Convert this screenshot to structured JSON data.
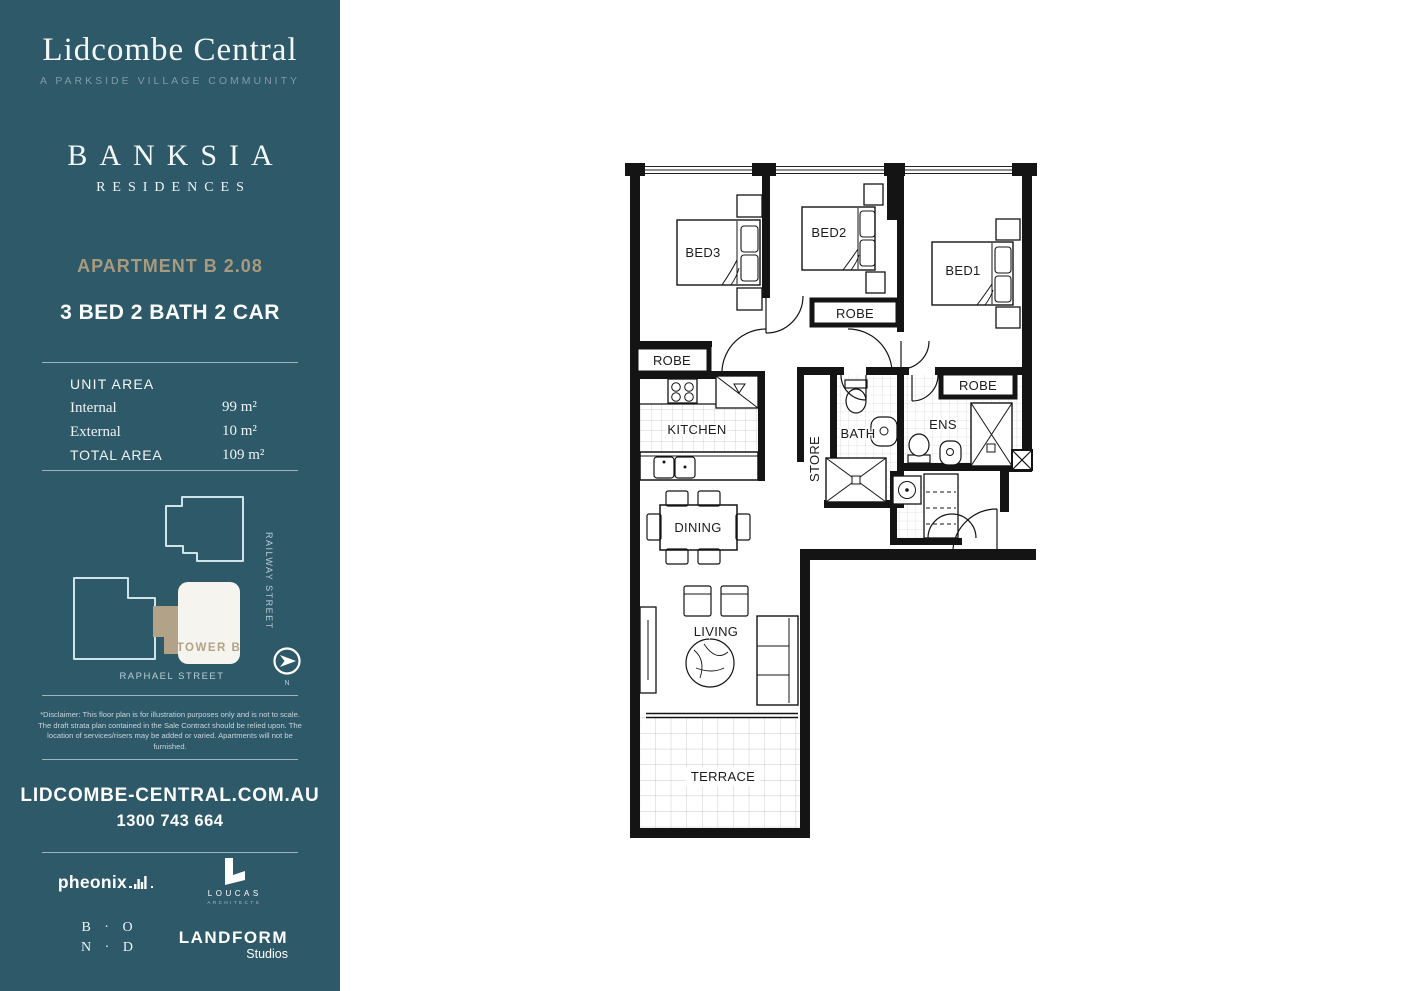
{
  "colors": {
    "sidebar_bg": "#2e5968",
    "accent_gold": "#a89a7f",
    "map_outline": "#cfe3ea",
    "tower_fill": "#f6f4ef",
    "connector_tan": "#b2a287",
    "plan_line": "#141414"
  },
  "sidebar": {
    "brand_title": "Lidcombe Central",
    "brand_subtitle": "A PARKSIDE VILLAGE COMMUNITY",
    "residence_name": "BANKSIA",
    "residence_sub": "RESIDENCES",
    "apartment_label": "APARTMENT B 2.08",
    "apartment_config": "3 BED 2 BATH 2 CAR",
    "unit_area_heading": "UNIT AREA",
    "area_rows": [
      {
        "label": "Internal",
        "value": "99 m²"
      },
      {
        "label": "External",
        "value": "10 m²"
      },
      {
        "label": "TOTAL AREA",
        "value": "109 m²"
      }
    ],
    "map": {
      "tower": "TOWER B",
      "street_side": "RAILWAY STREET",
      "street_bottom": "RAPHAEL STREET",
      "compass": "N"
    },
    "disclaimer_lines": [
      "*Disclaimer: This floor plan is for illustration purposes only and is not to scale.",
      "The draft strata plan contained in the Sale Contract should be relied upon. The",
      "location of services/risers may be added or varied. Apartments will not be furnished."
    ],
    "website": "LIDCOMBE-CENTRAL.COM.AU",
    "phone": "1300 743 664",
    "logos": {
      "phoenix": "pheonix",
      "loucas": "LOUCAS",
      "loucas_sub": "ARCHITECTS",
      "bond_line1": "B · O",
      "bond_line2": "N · D",
      "landform": "LANDFORM",
      "landform_sub": "Studios"
    }
  },
  "floor_plan": {
    "labels": {
      "bed1": "BED1",
      "bed2": "BED2",
      "bed3": "BED3",
      "robe": "ROBE",
      "kitchen": "KITCHEN",
      "store": "STORE",
      "bath": "BATH",
      "ens": "ENS",
      "dining": "DINING",
      "living": "LIVING",
      "terrace": "TERRACE"
    }
  }
}
